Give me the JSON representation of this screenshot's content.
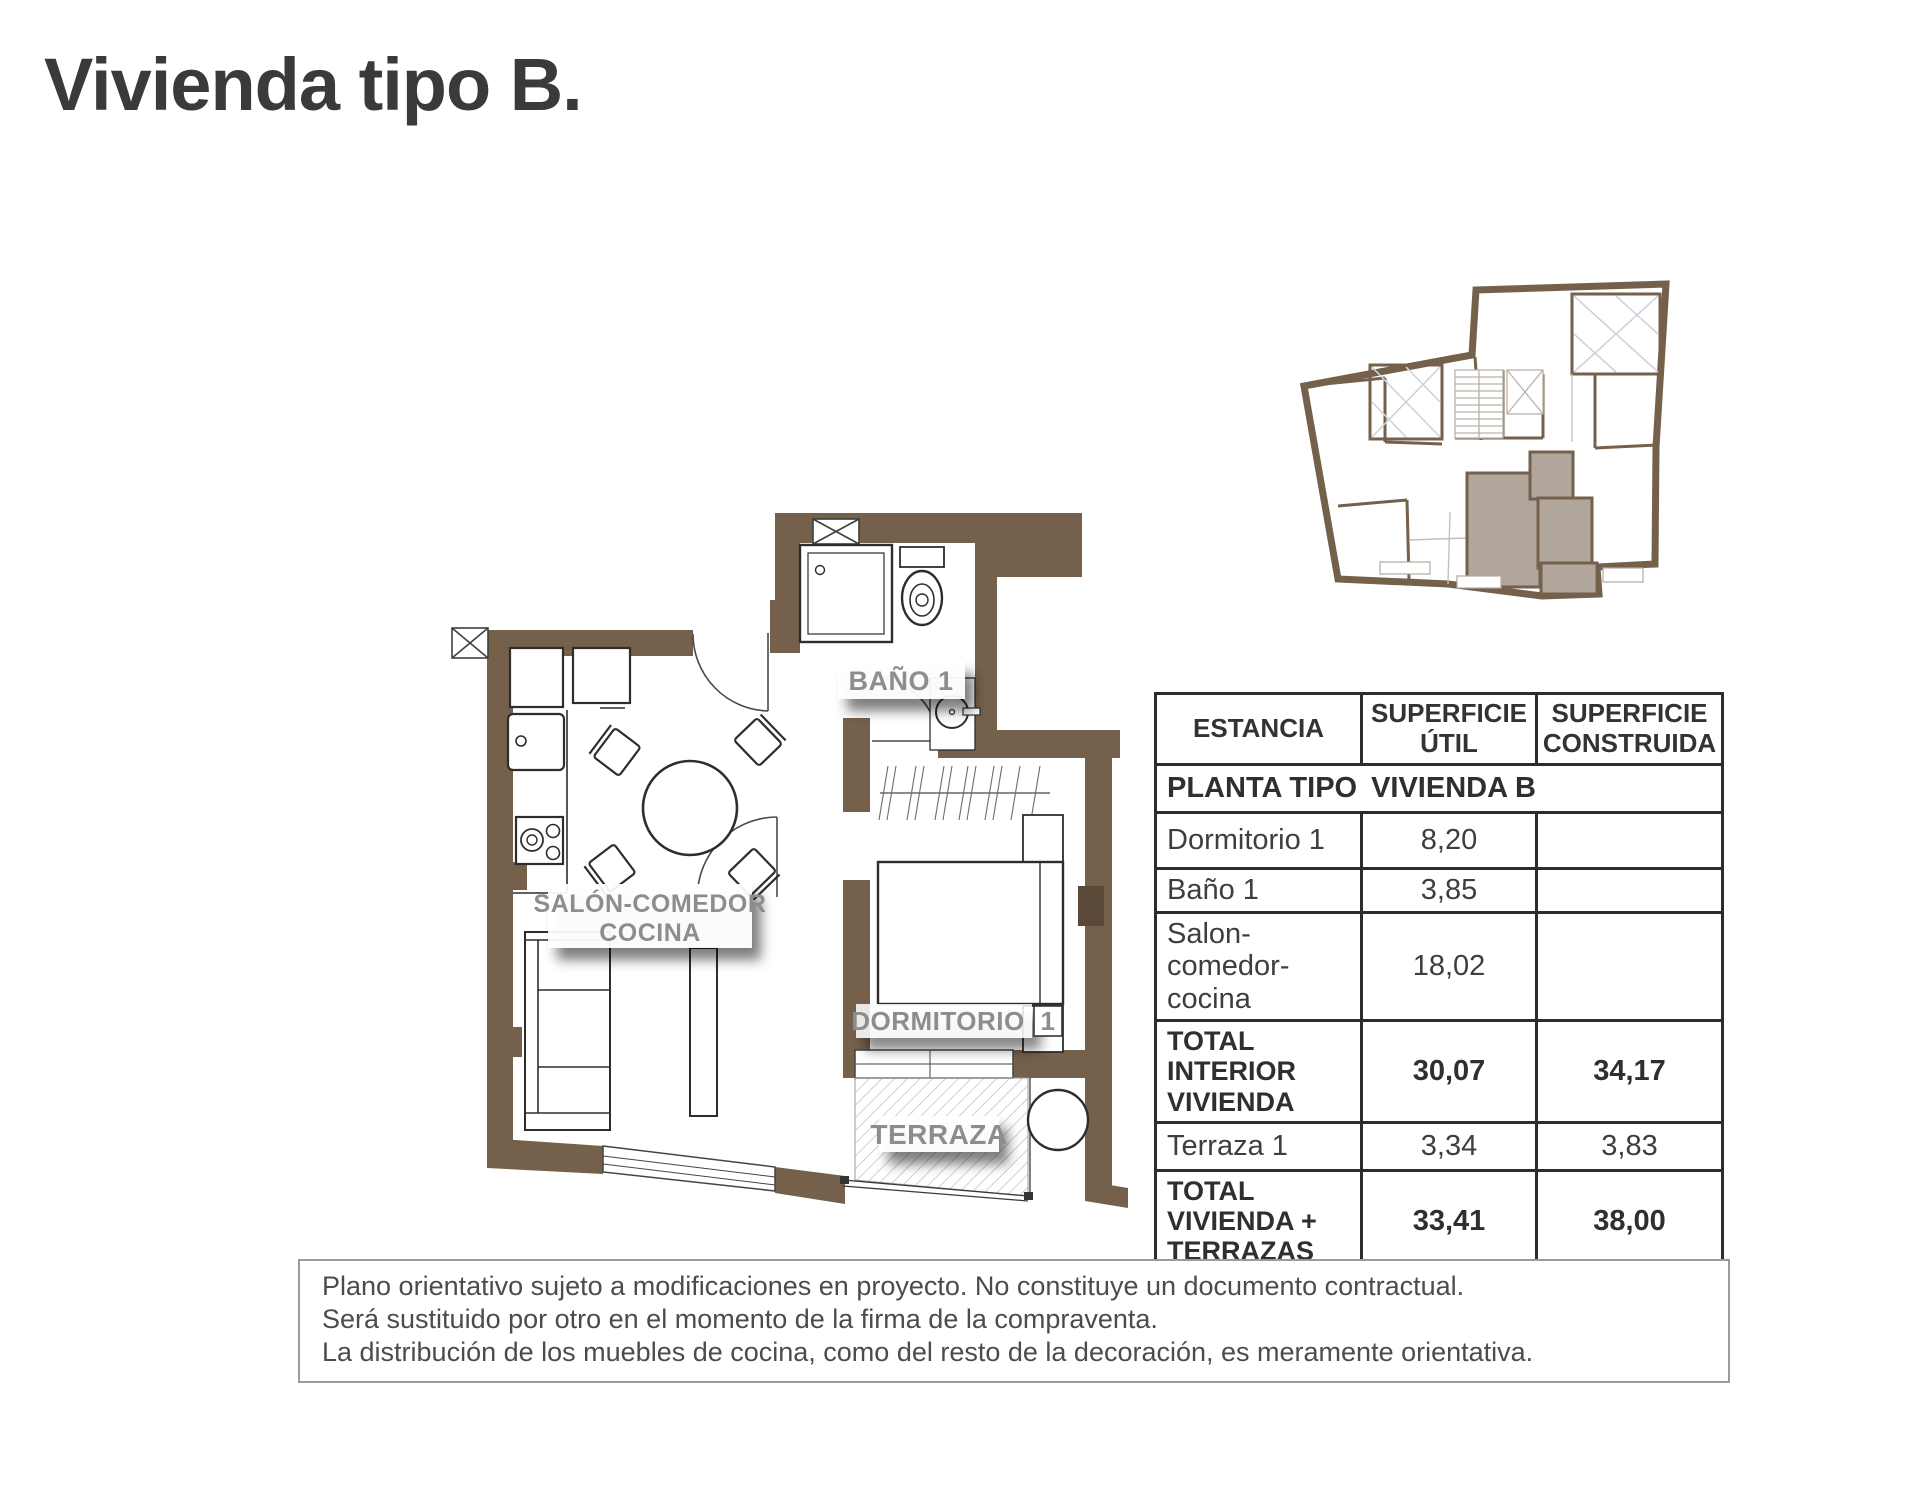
{
  "page": {
    "title": "Vivienda tipo B."
  },
  "colors": {
    "wall_brown": "#74604b",
    "unit_highlight": "#b1a69c",
    "room_label_gray": "#8d8d8d",
    "table_border": "#2c2c2c"
  },
  "floor_plan": {
    "labels": {
      "bathroom": "BAÑO 1",
      "living_line1": "SALÓN-COMEDOR",
      "living_line2": "COCINA",
      "bedroom": "DORMITORIO",
      "bedroom_number": "1",
      "terrace": "TERRAZA"
    }
  },
  "area_table": {
    "headers": [
      "ESTANCIA",
      "SUPERFICIE ÚTIL",
      "SUPERFICIE CONSTRUIDA"
    ],
    "plan_row": {
      "label": "PLANTA TIPO",
      "value": "VIVIENDA B"
    },
    "rows": [
      {
        "name": "Dormitorio 1",
        "util": "8,20",
        "construida": ""
      },
      {
        "name": "Baño 1",
        "util": "3,85",
        "construida": ""
      },
      {
        "name": "Salon-comedor-cocina",
        "util": "18,02",
        "construida": ""
      },
      {
        "name": "TOTAL INTERIOR VIVIENDA",
        "util": "30,07",
        "construida": "34,17"
      },
      {
        "name": "Terraza 1",
        "util": "3,34",
        "construida": "3,83"
      },
      {
        "name": "TOTAL VIVIENDA + TERRAZAS",
        "util": "33,41",
        "construida": "38,00"
      }
    ]
  },
  "disclaimer": {
    "lines": [
      "Plano orientativo sujeto a modificaciones en proyecto. No constituye un documento contractual.",
      "Será sustituido por otro en el momento de la firma de la compraventa.",
      "La distribución de los muebles de cocina, como del resto de la decoración, es meramente orientativa."
    ]
  }
}
